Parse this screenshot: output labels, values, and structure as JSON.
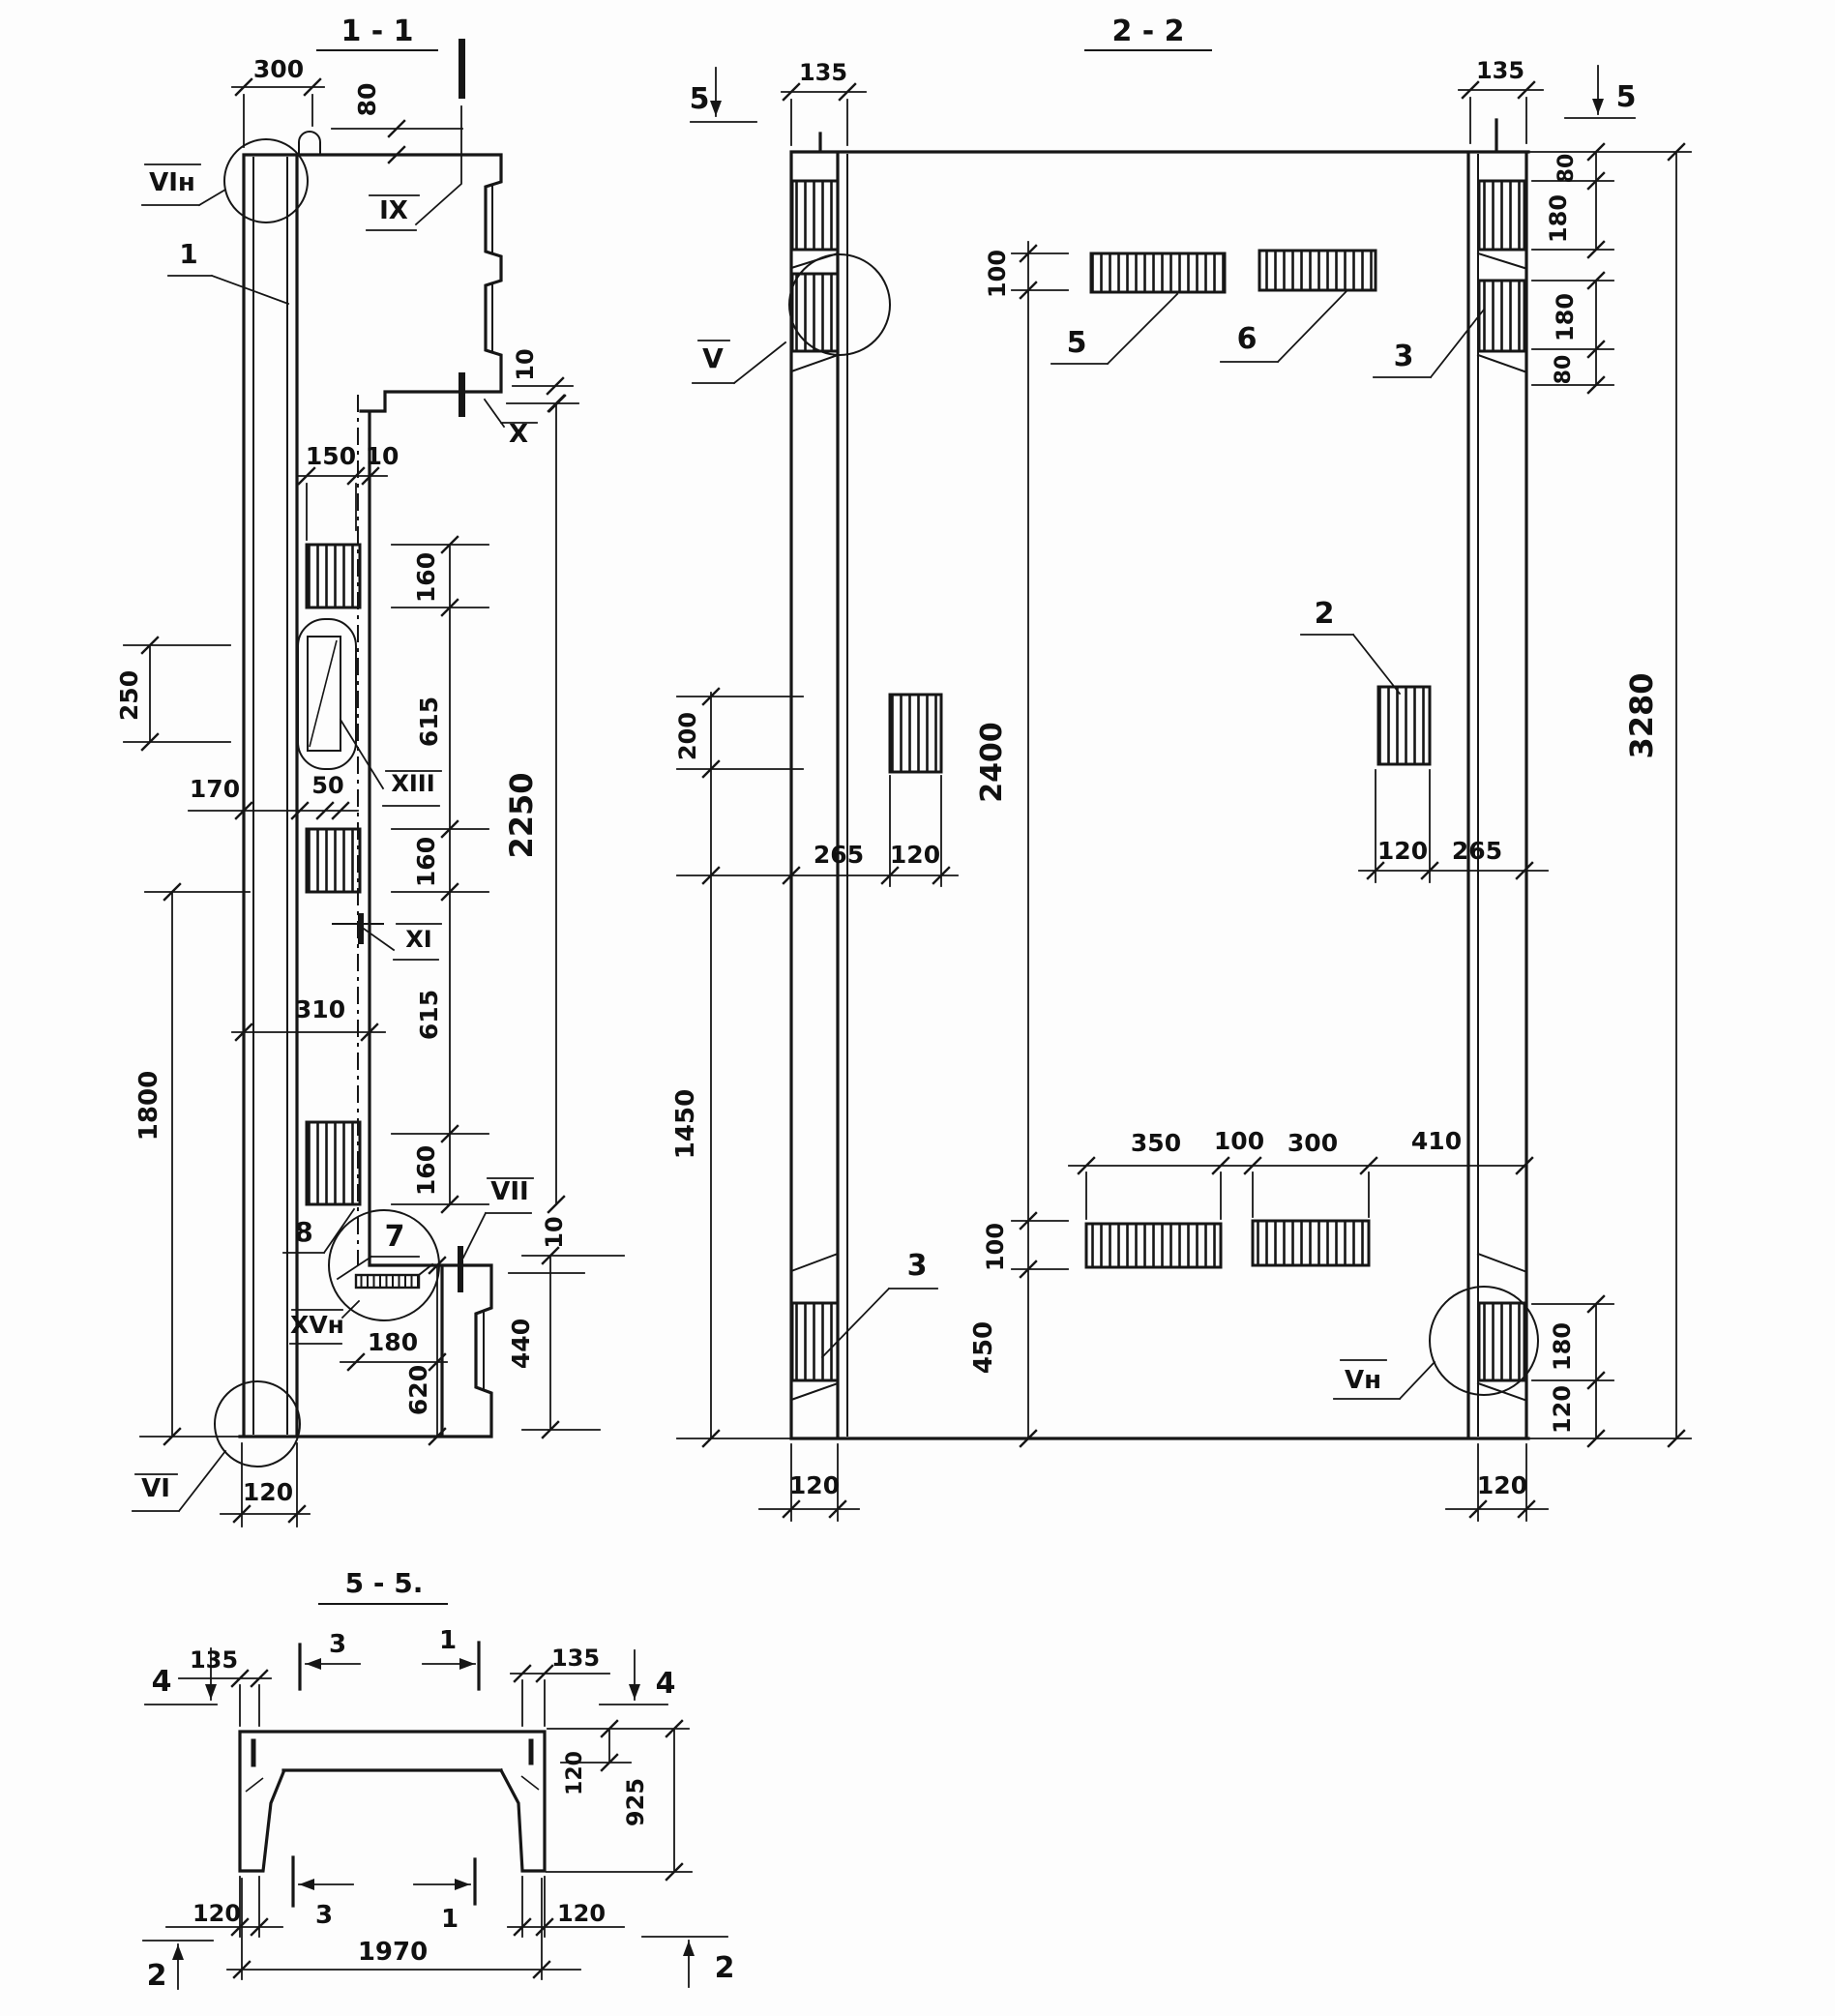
{
  "colors": {
    "ink": "#161616",
    "paper": "#fdfdfd"
  },
  "drawing": {
    "s11": {
      "title": "1 - 1",
      "dims": {
        "d300": "300",
        "d80": "80",
        "d10a": "10",
        "d150": "150",
        "d10b": "10",
        "d160a": "160",
        "d615a": "615",
        "d160b": "160",
        "d615b": "615",
        "d160c": "160",
        "d2250": "2250",
        "d250": "250",
        "d170": "170",
        "d50": "50",
        "d310": "310",
        "d1800": "1800",
        "d180": "180",
        "d620": "620",
        "d440": "440",
        "d10c": "10",
        "d120": "120"
      },
      "marks": {
        "vi_n": "VIн",
        "ix": "IX",
        "x": "X",
        "xiii": "XIII",
        "xi": "XI",
        "vii": "VII",
        "xv_n": "XVн",
        "vi": "VI"
      },
      "parts": {
        "p1": "1",
        "p8": "8",
        "p7": "7"
      }
    },
    "s22": {
      "title": "2 - 2",
      "markers": {
        "m5l": "5",
        "m5r": "5"
      },
      "dims": {
        "d135l": "135",
        "d135r": "135",
        "d100t": "100",
        "d80a": "80",
        "d180a": "180",
        "d180b": "180",
        "d80b": "80",
        "d3280": "3280",
        "d200": "200",
        "d1450": "1450",
        "d2400": "2400",
        "d100b": "100",
        "d450": "450",
        "d265l": "265",
        "d120l": "120",
        "d120r": "120",
        "d265r": "265",
        "d350": "350",
        "d100m": "100",
        "d300": "300",
        "d410": "410",
        "d180c": "180",
        "d120c": "120",
        "d120bl": "120",
        "d120br": "120"
      },
      "marks": {
        "v": "V",
        "v_n": "Vн"
      },
      "parts": {
        "p5": "5",
        "p6": "6",
        "p2": "2",
        "p3r": "3",
        "p3l": "3"
      }
    },
    "s55": {
      "title": "5 - 5.",
      "markers": {
        "m4l": "4",
        "m4r": "4",
        "m3t": "3",
        "m1t": "1",
        "m3b": "3",
        "m1b": "1",
        "m2l": "2",
        "m2r": "2"
      },
      "dims": {
        "d135l": "135",
        "d135r": "135",
        "d120f": "120",
        "d925": "925",
        "d120bl": "120",
        "d120br": "120",
        "d1970": "1970"
      }
    }
  }
}
